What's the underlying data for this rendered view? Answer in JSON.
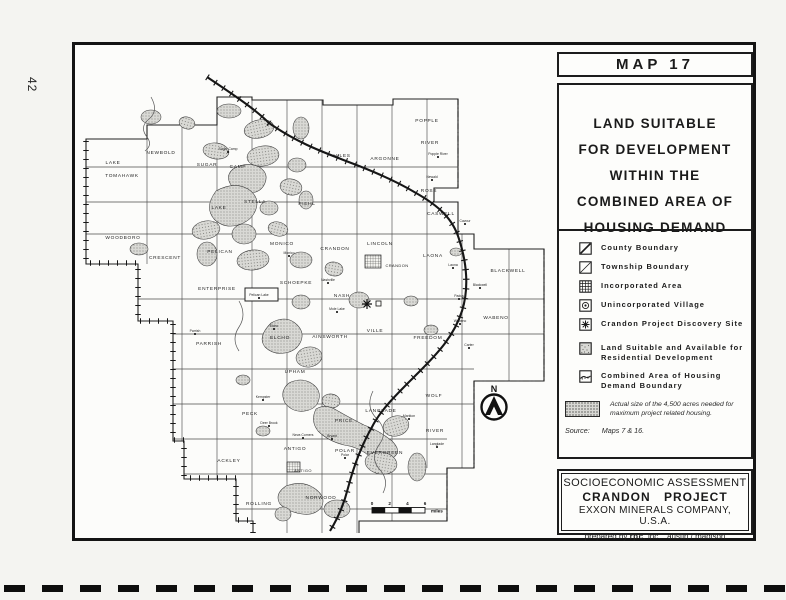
{
  "page": {
    "number": "42"
  },
  "panel": {
    "map_label": "MAP 17",
    "title_lines": [
      "LAND SUITABLE",
      "FOR DEVELOPMENT",
      "WITHIN THE",
      "COMBINED AREA OF",
      "HOUSING DEMAND"
    ],
    "legend": [
      {
        "icon": "county-boundary-icon",
        "label": "County Boundary"
      },
      {
        "icon": "township-boundary-icon",
        "label": "Township Boundary"
      },
      {
        "icon": "incorporated-area-icon",
        "label": "Incorporated Area"
      },
      {
        "icon": "unincorporated-village-icon",
        "label": "Unincorporated Village"
      },
      {
        "icon": "discovery-site-icon",
        "label": "Crandon Project Discovery Site"
      },
      {
        "icon": "land-suitable-icon",
        "label": "Land Suitable and Available for Residential Development"
      },
      {
        "icon": "combined-boundary-icon",
        "label": "Combined Area of Housing Demand Boundary"
      }
    ],
    "acres_note": "Actual size of the 4,500 acres needed for maximum project related housing.",
    "source_label": "Source:",
    "source_value": "Maps 7 & 16.",
    "attribution": {
      "line1": "SOCIOECONOMIC ASSESSMENT",
      "line2": "CRANDON PROJECT",
      "line3": "EXXON MINERALS COMPANY, U.S.A.",
      "prepared": "prepared by",
      "firm": "rpc",
      "firm_suffix": ", inc.",
      "location": "austin / madison"
    }
  },
  "map": {
    "north_label": "N",
    "scale": {
      "ticks": [
        "0",
        "2",
        "4",
        "6"
      ],
      "unit": "miles"
    },
    "townships": [
      {
        "t": "LAKE",
        "x": 112,
        "y": 163
      },
      {
        "t": "TOMAHAWK",
        "x": 121,
        "y": 176
      },
      {
        "t": "NEWBOLD",
        "x": 160,
        "y": 153
      },
      {
        "t": "SUGAR",
        "x": 206,
        "y": 165
      },
      {
        "t": "CAMP",
        "x": 237,
        "y": 167
      },
      {
        "t": "LAKE",
        "x": 218,
        "y": 208
      },
      {
        "t": "STELLA",
        "x": 254,
        "y": 202
      },
      {
        "t": "PIEHL",
        "x": 306,
        "y": 204
      },
      {
        "t": "HILES",
        "x": 341,
        "y": 156
      },
      {
        "t": "ARGONNE",
        "x": 384,
        "y": 159
      },
      {
        "t": "POPPLE",
        "x": 426,
        "y": 121
      },
      {
        "t": "RIVER",
        "x": 429,
        "y": 143
      },
      {
        "t": "ROSS",
        "x": 428,
        "y": 191
      },
      {
        "t": "CASWELL",
        "x": 440,
        "y": 214
      },
      {
        "t": "WOODBORO",
        "x": 122,
        "y": 238
      },
      {
        "t": "CRESCENT",
        "x": 164,
        "y": 258
      },
      {
        "t": "PELICAN",
        "x": 219,
        "y": 252
      },
      {
        "t": "MONICO",
        "x": 281,
        "y": 244
      },
      {
        "t": "ENTERPRISE",
        "x": 216,
        "y": 289
      },
      {
        "t": "SCHOEPKE",
        "x": 295,
        "y": 283
      },
      {
        "t": "CRANDON",
        "x": 334,
        "y": 249
      },
      {
        "t": "LINCOLN",
        "x": 379,
        "y": 244
      },
      {
        "t": "LAONA",
        "x": 432,
        "y": 256
      },
      {
        "t": "BLACKWELL",
        "x": 507,
        "y": 271
      },
      {
        "t": "NASH",
        "x": 341,
        "y": 296
      },
      {
        "t": "VILLE",
        "x": 374,
        "y": 331
      },
      {
        "t": "WABENO",
        "x": 495,
        "y": 318
      },
      {
        "t": "AINSWORTH",
        "x": 329,
        "y": 337
      },
      {
        "t": "FREEDOM",
        "x": 427,
        "y": 338
      },
      {
        "t": "PARRISH",
        "x": 208,
        "y": 344
      },
      {
        "t": "ELCHO",
        "x": 279,
        "y": 338
      },
      {
        "t": "UPHAM",
        "x": 294,
        "y": 372
      },
      {
        "t": "PECK",
        "x": 249,
        "y": 414
      },
      {
        "t": "ACKLEY",
        "x": 228,
        "y": 461
      },
      {
        "t": "ANTIGO",
        "x": 294,
        "y": 449
      },
      {
        "t": "POLAR",
        "x": 344,
        "y": 451
      },
      {
        "t": "EVERGREEN",
        "x": 384,
        "y": 453
      },
      {
        "t": "PRICE",
        "x": 343,
        "y": 421
      },
      {
        "t": "LANGLADE",
        "x": 380,
        "y": 411
      },
      {
        "t": "WOLF",
        "x": 433,
        "y": 396
      },
      {
        "t": "RIVER",
        "x": 434,
        "y": 431
      },
      {
        "t": "ROLLING",
        "x": 258,
        "y": 504
      },
      {
        "t": "NORWOOD",
        "x": 320,
        "y": 498
      }
    ],
    "villages": [
      {
        "t": "Sugar Camp",
        "x": 227,
        "y": 151
      },
      {
        "t": "Monico",
        "x": 288,
        "y": 255
      },
      {
        "t": "Pelican Lake",
        "x": 258,
        "y": 297
      },
      {
        "t": "Nashville",
        "x": 327,
        "y": 282
      },
      {
        "t": "Mole Lake",
        "x": 336,
        "y": 311
      },
      {
        "t": "Popple River",
        "x": 437,
        "y": 156
      },
      {
        "t": "Newald",
        "x": 431,
        "y": 179
      },
      {
        "t": "Cavour",
        "x": 464,
        "y": 223
      },
      {
        "t": "Laona",
        "x": 452,
        "y": 267
      },
      {
        "t": "Blackwell",
        "x": 479,
        "y": 287
      },
      {
        "t": "Padus",
        "x": 458,
        "y": 298
      },
      {
        "t": "Wabeno",
        "x": 459,
        "y": 323
      },
      {
        "t": "Carter",
        "x": 468,
        "y": 347
      },
      {
        "t": "Parrish",
        "x": 194,
        "y": 333
      },
      {
        "t": "Elcho",
        "x": 273,
        "y": 328
      },
      {
        "t": "Kempster",
        "x": 262,
        "y": 399
      },
      {
        "t": "Deer Brook",
        "x": 268,
        "y": 425
      },
      {
        "t": "Neva Corners",
        "x": 302,
        "y": 437
      },
      {
        "t": "Bryant",
        "x": 331,
        "y": 438
      },
      {
        "t": "Polar",
        "x": 344,
        "y": 457
      },
      {
        "t": "Markton",
        "x": 408,
        "y": 418
      },
      {
        "t": "Langlade",
        "x": 436,
        "y": 446
      }
    ],
    "cities": [
      {
        "t": "CRANDON",
        "x": 396,
        "y": 266
      },
      {
        "t": "ANTIGO",
        "x": 302,
        "y": 471
      }
    ]
  }
}
